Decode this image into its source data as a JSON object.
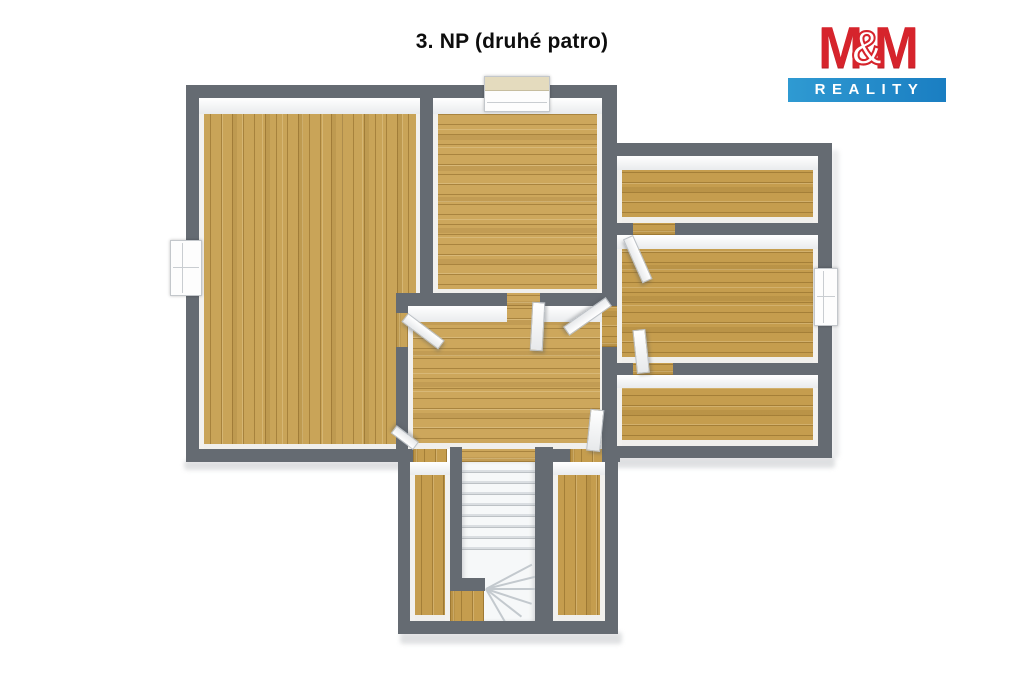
{
  "title": "3. NP (druhé patro)",
  "logo": {
    "m1": "M",
    "amp": "&",
    "m2": "M",
    "reality": "REALITY",
    "brand_red": "#d6242c",
    "brand_blue": "#1f86c6"
  },
  "colors": {
    "wall_gray": "#656b72",
    "wood_tan": "#c9a458",
    "wood_deep": "#c59d4e",
    "wood_light": "#cda75c",
    "stair_white": "#f6f8f9",
    "slab_shadow": "#d7d9db"
  },
  "floorplan": {
    "floor_label": "3. NP (druhé patro)",
    "elements": {
      "rooms": [
        "large-left-room",
        "top-center-room",
        "hallway",
        "right-top-room",
        "right-middle-room",
        "right-bottom-room",
        "bottom-left-room",
        "bottom-right-room"
      ],
      "windows": 3,
      "door_leaves": 7,
      "staircase": "winder-stair-bottom-center"
    }
  }
}
